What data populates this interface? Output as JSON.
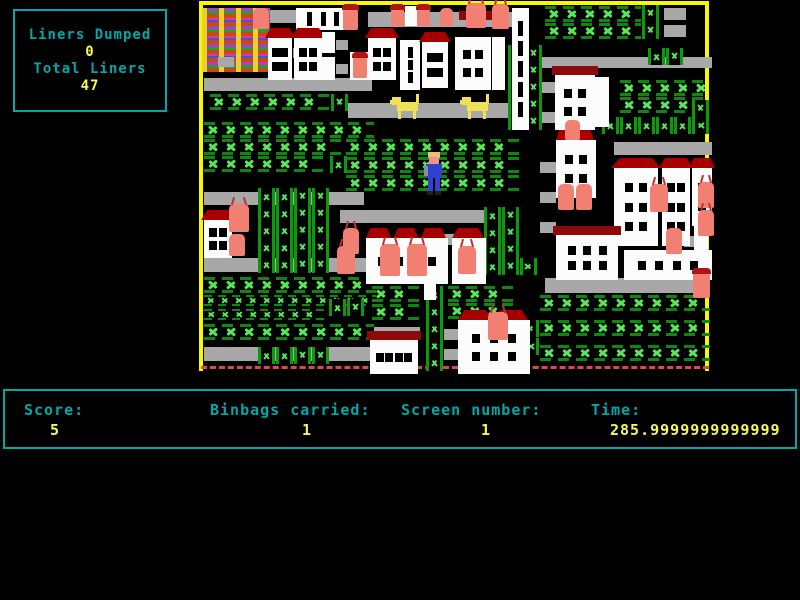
{
  "hud": {
    "liners_dumped_label": "Liners Dumped",
    "liners_dumped_value": "0",
    "total_liners_label": "Total Liners",
    "total_liners_value": "47"
  },
  "status": {
    "score_label": "Score:",
    "score_value": "5",
    "binbags_label": "Binbags carried:",
    "binbags_value": "1",
    "screen_label": "Screen number:",
    "screen_value": "1",
    "time_label": "Time:",
    "time_value": "285.9999999999999"
  },
  "colors": {
    "hud_text": "#00A8A8",
    "hud_value": "#F8F855",
    "playfield_border": "#F8F800",
    "bottom_border": "#E04848",
    "road": "#A8A8A8",
    "chevron": "#57E857",
    "chevron_dash": "#0E870E",
    "building": "#FCFCFC",
    "roof": "#A80000",
    "bin": "#F28072",
    "dog": "#EFE055",
    "player_shirt": "#3040D0"
  },
  "playfield": {
    "frame": {
      "x": 199,
      "y": 1,
      "w": 510,
      "h": 370
    },
    "dump": {
      "x": 202,
      "y": 8,
      "w": 68,
      "h": 64
    },
    "dump_notch": {
      "x": 218,
      "y": 57,
      "w": 16,
      "h": 10
    },
    "roads": [
      {
        "x": 368,
        "y": 12,
        "w": 152,
        "h": 15
      },
      {
        "x": 266,
        "y": 10,
        "w": 30,
        "h": 13
      },
      {
        "x": 204,
        "y": 78,
        "w": 168,
        "h": 13
      },
      {
        "x": 348,
        "y": 103,
        "w": 172,
        "h": 15
      },
      {
        "x": 524,
        "y": 57,
        "w": 188,
        "h": 11
      },
      {
        "x": 664,
        "y": 8,
        "w": 22,
        "h": 12
      },
      {
        "x": 664,
        "y": 25,
        "w": 22,
        "h": 12
      },
      {
        "x": 204,
        "y": 192,
        "w": 160,
        "h": 13
      },
      {
        "x": 340,
        "y": 210,
        "w": 152,
        "h": 13
      },
      {
        "x": 204,
        "y": 258,
        "w": 172,
        "h": 14
      },
      {
        "x": 545,
        "y": 278,
        "w": 148,
        "h": 15
      },
      {
        "x": 204,
        "y": 347,
        "w": 172,
        "h": 14
      },
      {
        "x": 374,
        "y": 327,
        "w": 46,
        "h": 12
      },
      {
        "x": 444,
        "y": 329,
        "w": 18,
        "h": 11
      },
      {
        "x": 444,
        "y": 349,
        "w": 18,
        "h": 11
      },
      {
        "x": 614,
        "y": 142,
        "w": 98,
        "h": 13
      },
      {
        "x": 540,
        "y": 82,
        "w": 15,
        "h": 11
      },
      {
        "x": 540,
        "y": 112,
        "w": 15,
        "h": 11
      },
      {
        "x": 540,
        "y": 162,
        "w": 16,
        "h": 11
      },
      {
        "x": 540,
        "y": 192,
        "w": 16,
        "h": 11
      },
      {
        "x": 540,
        "y": 222,
        "w": 16,
        "h": 11
      },
      {
        "x": 336,
        "y": 40,
        "w": 12,
        "h": 10
      },
      {
        "x": 336,
        "y": 64,
        "w": 12,
        "h": 10
      },
      {
        "x": 684,
        "y": 236,
        "w": 12,
        "h": 11
      },
      {
        "x": 444,
        "y": 234,
        "w": 12,
        "h": 11
      },
      {
        "x": 293,
        "y": 48,
        "w": 12,
        "h": 10
      }
    ],
    "chevron_rows": [
      {
        "x": 545,
        "y": 6,
        "w": 96,
        "dir": "right"
      },
      {
        "x": 545,
        "y": 23,
        "w": 96,
        "dir": "left"
      },
      {
        "x": 620,
        "y": 80,
        "w": 90,
        "dir": "right"
      },
      {
        "x": 620,
        "y": 97,
        "w": 90,
        "dir": "left"
      },
      {
        "x": 210,
        "y": 94,
        "w": 120,
        "dir": "right"
      },
      {
        "x": 204,
        "y": 122,
        "w": 170,
        "dir": "right"
      },
      {
        "x": 204,
        "y": 139,
        "w": 140,
        "dir": "left"
      },
      {
        "x": 204,
        "y": 156,
        "w": 124,
        "dir": "left"
      },
      {
        "x": 346,
        "y": 139,
        "w": 174,
        "dir": "right"
      },
      {
        "x": 346,
        "y": 157,
        "w": 174,
        "dir": "left"
      },
      {
        "x": 346,
        "y": 175,
        "w": 174,
        "dir": "left"
      },
      {
        "x": 204,
        "y": 277,
        "w": 172,
        "dir": "right"
      },
      {
        "x": 204,
        "y": 295,
        "w": 172,
        "dir": "right",
        "small": true
      },
      {
        "x": 204,
        "y": 309,
        "w": 120,
        "dir": "left",
        "small": true
      },
      {
        "x": 204,
        "y": 324,
        "w": 170,
        "dir": "left"
      },
      {
        "x": 540,
        "y": 295,
        "w": 170,
        "dir": "right"
      },
      {
        "x": 540,
        "y": 320,
        "w": 170,
        "dir": "right"
      },
      {
        "x": 540,
        "y": 345,
        "w": 170,
        "dir": "left"
      },
      {
        "x": 372,
        "y": 286,
        "w": 50,
        "dir": "right"
      },
      {
        "x": 372,
        "y": 304,
        "w": 48,
        "dir": "left"
      },
      {
        "x": 448,
        "y": 286,
        "w": 68,
        "dir": "right"
      },
      {
        "x": 448,
        "y": 303,
        "w": 68,
        "dir": "right"
      }
    ],
    "arrow_tiles": [
      {
        "x": 331,
        "y": 94,
        "dir": "down"
      },
      {
        "x": 642,
        "y": 5,
        "dir": "down"
      },
      {
        "x": 642,
        "y": 22,
        "dir": "down"
      },
      {
        "x": 648,
        "y": 48,
        "dir": "up"
      },
      {
        "x": 666,
        "y": 48,
        "dir": "down"
      },
      {
        "x": 258,
        "y": 188,
        "dir": "up"
      },
      {
        "x": 276,
        "y": 188,
        "dir": "up"
      },
      {
        "x": 294,
        "y": 188,
        "dir": "down"
      },
      {
        "x": 312,
        "y": 188,
        "dir": "down"
      },
      {
        "x": 258,
        "y": 205,
        "dir": "up"
      },
      {
        "x": 276,
        "y": 205,
        "dir": "up"
      },
      {
        "x": 294,
        "y": 205,
        "dir": "down"
      },
      {
        "x": 312,
        "y": 205,
        "dir": "down"
      },
      {
        "x": 258,
        "y": 222,
        "dir": "up"
      },
      {
        "x": 276,
        "y": 222,
        "dir": "up"
      },
      {
        "x": 294,
        "y": 222,
        "dir": "down"
      },
      {
        "x": 312,
        "y": 222,
        "dir": "down"
      },
      {
        "x": 258,
        "y": 239,
        "dir": "up"
      },
      {
        "x": 276,
        "y": 239,
        "dir": "up"
      },
      {
        "x": 294,
        "y": 239,
        "dir": "down"
      },
      {
        "x": 312,
        "y": 239,
        "dir": "down"
      },
      {
        "x": 258,
        "y": 256,
        "dir": "up"
      },
      {
        "x": 276,
        "y": 256,
        "dir": "up"
      },
      {
        "x": 294,
        "y": 256,
        "dir": "down"
      },
      {
        "x": 312,
        "y": 256,
        "dir": "down"
      },
      {
        "x": 258,
        "y": 347,
        "dir": "up"
      },
      {
        "x": 276,
        "y": 347,
        "dir": "up"
      },
      {
        "x": 294,
        "y": 347,
        "dir": "down"
      },
      {
        "x": 312,
        "y": 347,
        "dir": "down"
      },
      {
        "x": 508,
        "y": 45,
        "dir": "up"
      },
      {
        "x": 525,
        "y": 45,
        "dir": "down"
      },
      {
        "x": 508,
        "y": 62,
        "dir": "up"
      },
      {
        "x": 525,
        "y": 62,
        "dir": "down"
      },
      {
        "x": 508,
        "y": 79,
        "dir": "up"
      },
      {
        "x": 525,
        "y": 79,
        "dir": "down"
      },
      {
        "x": 508,
        "y": 96,
        "dir": "up"
      },
      {
        "x": 525,
        "y": 96,
        "dir": "down"
      },
      {
        "x": 508,
        "y": 113,
        "dir": "up"
      },
      {
        "x": 525,
        "y": 113,
        "dir": "down"
      },
      {
        "x": 484,
        "y": 207,
        "dir": "up"
      },
      {
        "x": 502,
        "y": 207,
        "dir": "down"
      },
      {
        "x": 484,
        "y": 224,
        "dir": "up"
      },
      {
        "x": 502,
        "y": 224,
        "dir": "down"
      },
      {
        "x": 484,
        "y": 241,
        "dir": "up"
      },
      {
        "x": 502,
        "y": 241,
        "dir": "down"
      },
      {
        "x": 484,
        "y": 258,
        "dir": "up"
      },
      {
        "x": 502,
        "y": 258,
        "dir": "down"
      },
      {
        "x": 520,
        "y": 258,
        "dir": "right"
      },
      {
        "x": 602,
        "y": 117,
        "dir": "up"
      },
      {
        "x": 620,
        "y": 117,
        "dir": "up"
      },
      {
        "x": 638,
        "y": 117,
        "dir": "up"
      },
      {
        "x": 656,
        "y": 117,
        "dir": "up"
      },
      {
        "x": 674,
        "y": 117,
        "dir": "up"
      },
      {
        "x": 692,
        "y": 100,
        "dir": "down"
      },
      {
        "x": 692,
        "y": 117,
        "dir": "left"
      },
      {
        "x": 330,
        "y": 156,
        "dir": "up"
      },
      {
        "x": 329,
        "y": 299,
        "dir": "up"
      },
      {
        "x": 347,
        "y": 299,
        "dir": "down"
      },
      {
        "x": 426,
        "y": 286,
        "dir": "up"
      },
      {
        "x": 426,
        "y": 303,
        "dir": "up"
      },
      {
        "x": 426,
        "y": 320,
        "dir": "up"
      },
      {
        "x": 426,
        "y": 337,
        "dir": "up"
      },
      {
        "x": 426,
        "y": 354,
        "dir": "up"
      },
      {
        "x": 522,
        "y": 320,
        "dir": "right"
      },
      {
        "x": 522,
        "y": 338,
        "dir": "left"
      },
      {
        "x": 504,
        "y": 338,
        "dir": "down"
      }
    ],
    "buildings": [
      {
        "x": 296,
        "y": 8,
        "w": 54,
        "h": 22,
        "roof": "none",
        "wc": 3,
        "wr": 1,
        "slot": true
      },
      {
        "x": 405,
        "y": 6,
        "w": 12,
        "h": 20,
        "roof": "none",
        "wc": 0,
        "wr": 0
      },
      {
        "x": 268,
        "y": 38,
        "w": 24,
        "h": 42,
        "roof": "trap",
        "wc": 2,
        "wr": 2
      },
      {
        "x": 294,
        "y": 38,
        "w": 28,
        "h": 42,
        "roof": "trap",
        "wc": 2,
        "wr": 2
      },
      {
        "x": 322,
        "y": 32,
        "w": 13,
        "h": 21,
        "roof": "none",
        "wc": 0,
        "wr": 0
      },
      {
        "x": 322,
        "y": 57,
        "w": 13,
        "h": 23,
        "roof": "none",
        "wc": 0,
        "wr": 0
      },
      {
        "x": 350,
        "y": 52,
        "w": 20,
        "h": 28,
        "roof": "none",
        "wc": 0,
        "wr": 0
      },
      {
        "x": 368,
        "y": 38,
        "w": 28,
        "h": 42,
        "roof": "trap",
        "wc": 2,
        "wr": 2
      },
      {
        "x": 400,
        "y": 40,
        "w": 20,
        "h": 50,
        "roof": "none",
        "wc": 1,
        "wr": 3,
        "slot": true
      },
      {
        "x": 422,
        "y": 42,
        "w": 26,
        "h": 46,
        "roof": "trap",
        "wc": 2,
        "wr": 2
      },
      {
        "x": 455,
        "y": 37,
        "w": 36,
        "h": 53,
        "roof": "none",
        "wc": 2,
        "wr": 2
      },
      {
        "x": 492,
        "y": 37,
        "w": 13,
        "h": 53,
        "roof": "none",
        "wc": 0,
        "wr": 0
      },
      {
        "x": 512,
        "y": 8,
        "w": 17,
        "h": 122,
        "roof": "none",
        "wc": 1,
        "wr": 5,
        "slot": true
      },
      {
        "x": 462,
        "y": 20,
        "w": 34,
        "h": 0,
        "roof": "dark"
      },
      {
        "x": 555,
        "y": 75,
        "w": 40,
        "h": 55,
        "roof": "dark",
        "wc": 2,
        "wr": 2
      },
      {
        "x": 595,
        "y": 77,
        "w": 14,
        "h": 50,
        "roof": "none",
        "wc": 0,
        "wr": 0
      },
      {
        "x": 204,
        "y": 220,
        "w": 28,
        "h": 38,
        "roof": "trap",
        "wc": 2,
        "wr": 2
      },
      {
        "x": 556,
        "y": 140,
        "w": 40,
        "h": 58,
        "roof": "bumps",
        "bumps": 2,
        "wc": 2,
        "wr": 2
      },
      {
        "x": 614,
        "y": 168,
        "w": 44,
        "h": 78,
        "roof": "trap",
        "wc": 2,
        "wr": 3
      },
      {
        "x": 662,
        "y": 168,
        "w": 28,
        "h": 78,
        "roof": "trap",
        "wc": 2,
        "wr": 3
      },
      {
        "x": 692,
        "y": 168,
        "w": 20,
        "h": 58,
        "roof": "trap",
        "wc": 1,
        "wr": 2
      },
      {
        "x": 694,
        "y": 226,
        "w": 14,
        "h": 32,
        "roof": "none",
        "wc": 0,
        "wr": 0
      },
      {
        "x": 556,
        "y": 235,
        "w": 62,
        "h": 45,
        "roof": "dark",
        "wc": 3,
        "wr": 2
      },
      {
        "x": 624,
        "y": 250,
        "w": 88,
        "h": 30,
        "roof": "none",
        "wc": 4,
        "wr": 1
      },
      {
        "x": 366,
        "y": 238,
        "w": 82,
        "h": 46,
        "roof": "bumps",
        "bumps": 3,
        "wc": 4,
        "wr": 1
      },
      {
        "x": 452,
        "y": 238,
        "w": 34,
        "h": 46,
        "roof": "bumps",
        "bumps": 1,
        "wc": 1,
        "wr": 1
      },
      {
        "x": 458,
        "y": 320,
        "w": 72,
        "h": 54,
        "roof": "bumps",
        "bumps": 2,
        "wc": 3,
        "wr": 2
      },
      {
        "x": 370,
        "y": 340,
        "w": 48,
        "h": 34,
        "roof": "dark",
        "wc": 4,
        "wr": 1
      },
      {
        "x": 424,
        "y": 284,
        "w": 12,
        "h": 16,
        "roof": "none",
        "wc": 0,
        "wr": 0
      }
    ],
    "bins": [
      {
        "x": 253,
        "y": 8,
        "w": 16,
        "h": 21,
        "v": "plain"
      },
      {
        "x": 343,
        "y": 6,
        "w": 15,
        "h": 24,
        "v": "lid"
      },
      {
        "x": 391,
        "y": 6,
        "w": 13,
        "h": 20,
        "v": "lid"
      },
      {
        "x": 417,
        "y": 6,
        "w": 13,
        "h": 20,
        "v": "lid"
      },
      {
        "x": 440,
        "y": 8,
        "w": 13,
        "h": 18,
        "v": "plain"
      },
      {
        "x": 466,
        "y": 3,
        "w": 20,
        "h": 25,
        "v": "bag"
      },
      {
        "x": 492,
        "y": 4,
        "w": 17,
        "h": 25,
        "v": "bag"
      },
      {
        "x": 565,
        "y": 120,
        "w": 15,
        "h": 20,
        "v": "plain"
      },
      {
        "x": 229,
        "y": 204,
        "w": 20,
        "h": 28,
        "v": "bag"
      },
      {
        "x": 229,
        "y": 234,
        "w": 16,
        "h": 22,
        "v": "plain"
      },
      {
        "x": 337,
        "y": 246,
        "w": 18,
        "h": 28,
        "v": "bag"
      },
      {
        "x": 343,
        "y": 228,
        "w": 16,
        "h": 26,
        "v": "bag"
      },
      {
        "x": 380,
        "y": 244,
        "w": 20,
        "h": 32,
        "v": "bag"
      },
      {
        "x": 407,
        "y": 244,
        "w": 20,
        "h": 32,
        "v": "bag"
      },
      {
        "x": 458,
        "y": 246,
        "w": 18,
        "h": 28,
        "v": "bag"
      },
      {
        "x": 488,
        "y": 312,
        "w": 20,
        "h": 28,
        "v": "bag"
      },
      {
        "x": 558,
        "y": 184,
        "w": 16,
        "h": 26,
        "v": "plain"
      },
      {
        "x": 576,
        "y": 184,
        "w": 16,
        "h": 26,
        "v": "plain"
      },
      {
        "x": 650,
        "y": 184,
        "w": 18,
        "h": 28,
        "v": "bag"
      },
      {
        "x": 698,
        "y": 182,
        "w": 16,
        "h": 26,
        "v": "bag"
      },
      {
        "x": 698,
        "y": 210,
        "w": 16,
        "h": 26,
        "v": "bag"
      },
      {
        "x": 666,
        "y": 228,
        "w": 16,
        "h": 26,
        "v": "plain"
      },
      {
        "x": 693,
        "y": 270,
        "w": 17,
        "h": 28,
        "v": "lid"
      },
      {
        "x": 353,
        "y": 54,
        "w": 14,
        "h": 24,
        "v": "lid"
      }
    ],
    "dogs": [
      {
        "x": 390,
        "y": 92
      },
      {
        "x": 460,
        "y": 92
      }
    ],
    "player": {
      "x": 424,
      "y": 152
    }
  }
}
